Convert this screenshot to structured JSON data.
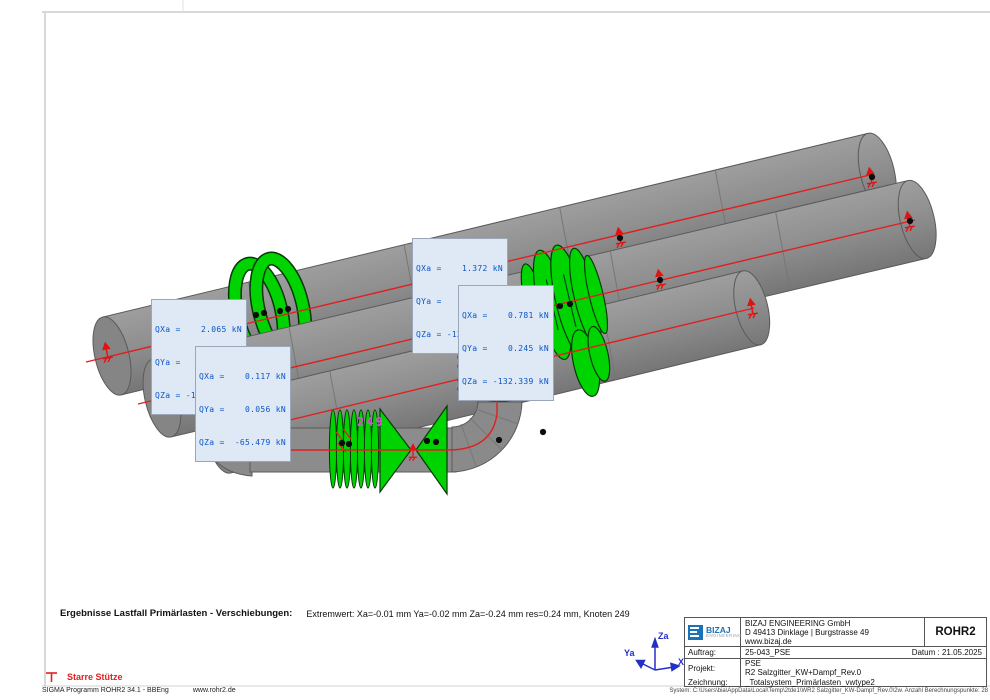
{
  "colors": {
    "pipe_gray": "#8f8f8f",
    "support_green": "#00d400",
    "centerline_red": "#e02020",
    "annotation_blue": "#0a54c8",
    "node_label_magenta": "#d651d6",
    "axes_blue": "#2230c8",
    "logo_blue": "#1a72b8"
  },
  "force_boxes": [
    {
      "lines": [
        "QXa =    2.065 kN",
        "QYa =   -1.281 kN",
        "QZa = -110.628 kN"
      ]
    },
    {
      "lines": [
        "QXa =    0.117 kN",
        "QYa =    0.056 kN",
        "QZa =  -65.479 kN"
      ]
    },
    {
      "lines": [
        "QXa =    1.372 kN",
        "QYa =   -0.159 kN",
        "QZa = -128.206 kN"
      ]
    },
    {
      "lines": [
        "QXa =    0.781 kN",
        "QYa =    0.245 kN",
        "QZa = -132.339 kN"
      ]
    }
  ],
  "node_label": "249",
  "axes": {
    "z": "Za",
    "y": "Ya",
    "x": "Xa"
  },
  "result_line": {
    "title": "Ergebnisse Lastfall Primärlasten - Verschiebungen:",
    "text": "Extremwert: Xa=-0.01 mm Ya=-0.02 mm Za=-0.24 mm res=0.24 mm, Knoten 249"
  },
  "legend": {
    "rigid_support": "Starre Stütze"
  },
  "footer": {
    "program": "SIGMA Programm ROHR2 34.1 - BBEng",
    "website": "www.rohr2.de",
    "system": "System: C:\\Users\\bia\\AppData\\Local\\Temp\\2tde1\\WR2 Salzgitter_KW-Dampf_Rev.0\\2w. Anzahl Berechnungspunkte: 28"
  },
  "title_block": {
    "logo": {
      "name": "BIZAJ",
      "subtitle": "ENGINEERING"
    },
    "company": [
      "BIZAJ ENGINEERING GmbH",
      "D 49413 Dinklage | Burgstrasse 49",
      "www.bizaj.de"
    ],
    "program": "ROHR2",
    "auftrag_label": "Auftrag:",
    "auftrag": "25-043_PSE",
    "datum_label": "Datum :",
    "datum": "21.05.2025",
    "projekt_label": "Projekt:",
    "projekt_line1": "PSE",
    "projekt_line2": "R2 Salzgitter_KW+Dampf_Rev.0",
    "zeichnung_label": "Zeichnung:",
    "zeichnung": "_Totalsystem_Primärlasten_vwtype2"
  }
}
